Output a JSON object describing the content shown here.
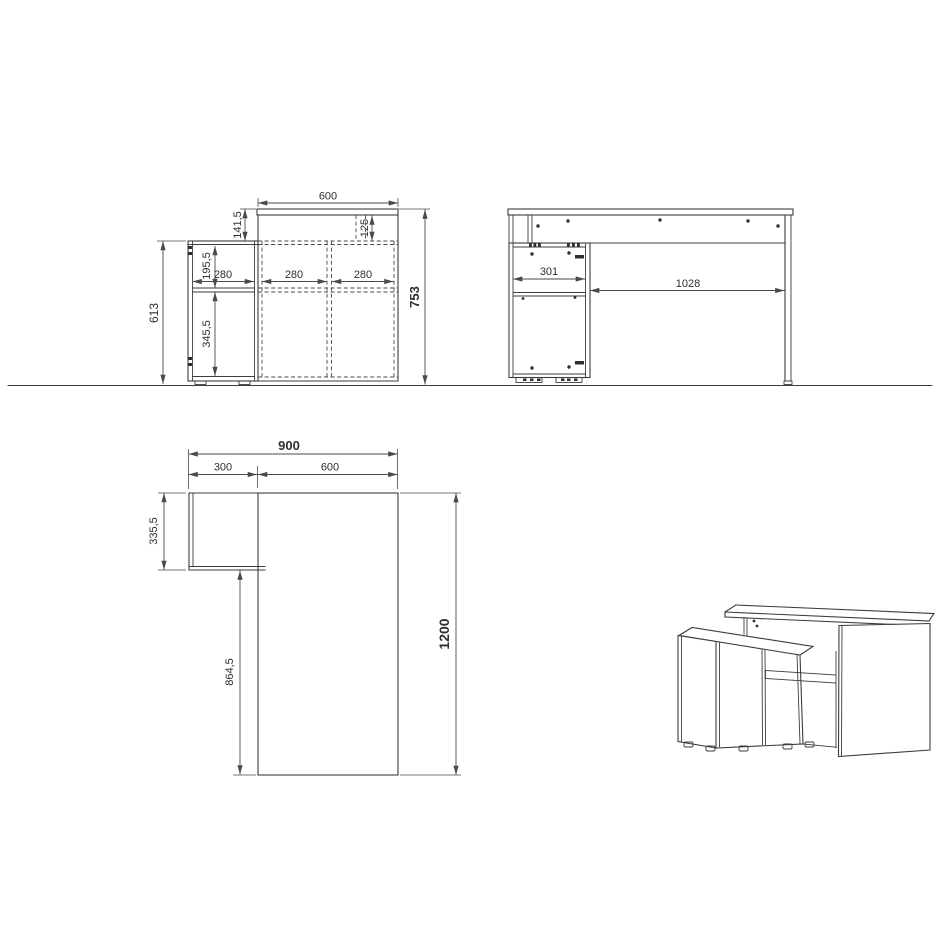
{
  "meta": {
    "background": "#ffffff",
    "line_color": "#3d3d3d",
    "dim_color": "#4a4a4a",
    "text_color": "#2f2f2f"
  },
  "views": {
    "front": {
      "dims": {
        "top_width": "600",
        "top_drop": "141,5",
        "top_inset": "125",
        "upper_section_height": "195,5",
        "bay_width_1": "280",
        "bay_width_2": "280",
        "bay_width_3": "280",
        "cabinet_height": "613",
        "lower_section_height": "345,5",
        "total_height": "753"
      }
    },
    "side": {
      "dims": {
        "cabinet_depth": "301",
        "open_depth": "1028"
      }
    },
    "plan": {
      "dims": {
        "total_width": "900",
        "cabinet_width": "300",
        "desk_width": "600",
        "cabinet_depth": "335,5",
        "lower_depth": "864,5",
        "total_depth": "1200"
      }
    }
  }
}
